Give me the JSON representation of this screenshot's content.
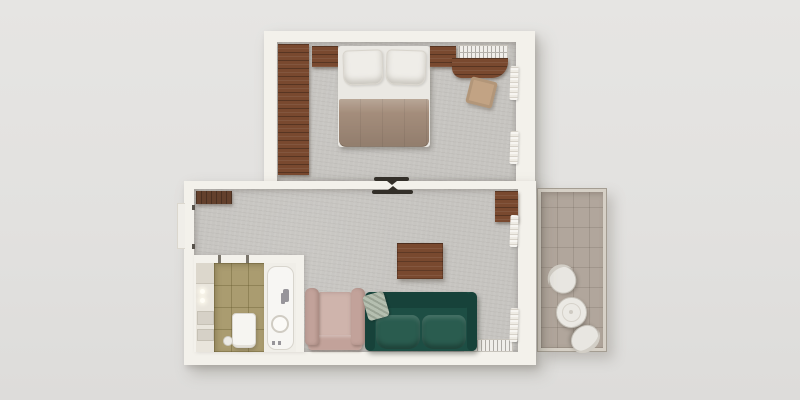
{
  "scene": {
    "title": "Top-down 3D render of a one-bedroom apartment floor plan",
    "room_list": [
      "bedroom",
      "living-room",
      "bathroom",
      "balcony"
    ]
  },
  "colors": {
    "bg-top": "#e6e5e3",
    "bg": "#e2e1df",
    "bg-bottom": "#dddcda",
    "wall": "#f3f1eb",
    "carpet": "#c6c4c0",
    "balcony-floor": "#b1a69c",
    "balcony-frame": "#d6d0c6",
    "tile": "#aa9c70",
    "tile-line": "rgba(95,85,40,0.35)",
    "wood": "#79492f",
    "cabinet": "#63402c",
    "bed-white": "#eae8e3",
    "blanket": "#a48d7b",
    "ottoman": "#c2a384",
    "sofa": "#1d4e44",
    "sofa-dark": "#17423a",
    "sofa-cushion": "#2a5c4f",
    "pillow-sage": "#b5bfb0",
    "armchair": "#c2a29a",
    "armchair-seat": "#cfb4ac",
    "radiator": "#f0eeea",
    "fixture-border": "#c8c4bc",
    "metal": "#97959a",
    "dark-mark": "#332f29"
  },
  "bedroom": {
    "label": "bedroom",
    "furniture": [
      "wardrobe",
      "nightstand",
      "double-bed",
      "pillow",
      "pillow",
      "blanket",
      "nightstand",
      "ac-vent",
      "desk",
      "ottoman",
      "curtain",
      "curtain"
    ]
  },
  "living_room": {
    "label": "living room",
    "furniture": [
      "console-cabinet",
      "side-desk",
      "dining-table",
      "armchair",
      "sofa",
      "throw-pillow",
      "radiator",
      "curtain",
      "curtain"
    ]
  },
  "bathroom": {
    "label": "bathroom",
    "furniture": [
      "vanity",
      "wall-lamps",
      "shelves",
      "floor-tiles",
      "bathtub",
      "faucet",
      "drain",
      "toilet",
      "toilet-brush"
    ]
  },
  "balcony": {
    "label": "balcony",
    "furniture": [
      "chair",
      "round-table",
      "chair"
    ]
  },
  "marks": {
    "door_bedroom": "open-door-leaf",
    "door_entry": "entry-door-recess"
  }
}
